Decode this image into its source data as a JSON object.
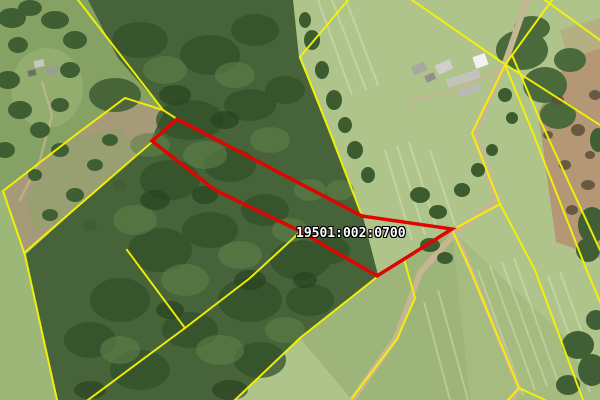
{
  "map": {
    "parcel_label": "19501:002:0700",
    "colors": {
      "boundary_yellow": "#f6f303",
      "parcel_red": "#e00500",
      "label_text": "#ffffff",
      "label_outline": "#000000"
    }
  }
}
